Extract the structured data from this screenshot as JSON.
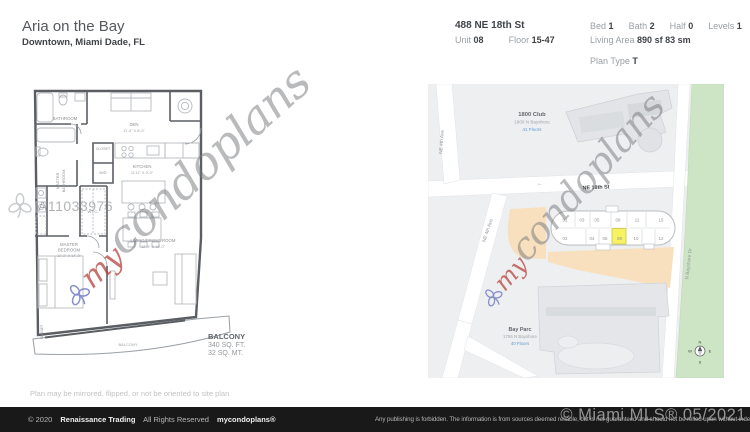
{
  "header": {
    "title": "Aria on the Bay",
    "subtitle": "Downtown, Miami Dade, FL",
    "address": "488 NE 18th St",
    "unit_label": "Unit",
    "unit_value": "08",
    "floor_label": "Floor",
    "floor_value": "15-47",
    "bed_label": "Bed",
    "bed_value": "1",
    "bath_label": "Bath",
    "bath_value": "2",
    "half_label": "Half",
    "half_value": "0",
    "levels_label": "Levels",
    "levels_value": "1",
    "living_label": "Living Area",
    "living_value": "890 sf 83 sm",
    "plan_type_label": "Plan Type",
    "plan_type_value": "T"
  },
  "plan": {
    "id_watermark": "A11033976",
    "bathroom": "BATHROOM",
    "master_bathroom_1": "MASTER",
    "master_bathroom_2": "BATHROOM",
    "den": "DEN",
    "den_dims": "11'-5\" X 8'-0\"",
    "closet_center": "CLOSET",
    "wd": "W/D",
    "kitchen": "KITCHEN",
    "kitchen_dims": "11'11\" X 9'-0\"",
    "wic": "W.I.C.",
    "closet_left": "CLOSET",
    "master_bedroom_1": "MASTER",
    "master_bedroom_2": "BEDROOM",
    "master_bedroom_dims": "11'-2\" X 14'-3\"",
    "living": "LIVING/DINING ROOM",
    "living_dims": "12'-9\" X 15'-0\"",
    "balcony": "BALCONY",
    "balcony_note1": "BALCONY",
    "balcony_note2": "340 SQ. FT.",
    "balcony_note3": "32 SQ. MT.",
    "disclaimer": "Plan may be mirrored, flipped, or not be oriented to site plan"
  },
  "map": {
    "street_ne4_top": "NE 4th Ave",
    "street_ne4_mid": "NE 4th Ave",
    "street_ne18": "NE 18th St",
    "street_bayshore": "N Bayshore Dr",
    "road_arrow": "←",
    "building_1800_name": "1800 Club",
    "building_1800_address": "1800 N Bayshore",
    "building_1800_floors": "41 Floors",
    "bayparc_name": "Bay Parc",
    "bayparc_address": "1756 N Bayshore",
    "bayparc_floors": "40 Floors",
    "units_top": [
      "01",
      "03",
      "05",
      "09",
      "11",
      "15"
    ],
    "units_bottom": [
      "02",
      "04",
      "06",
      "08",
      "10",
      "12"
    ],
    "highlighted_unit": "08",
    "compass_n": "N",
    "compass_e": "E",
    "compass_s": "S",
    "compass_w": "W",
    "colors": {
      "highlight": "#f6f263",
      "park": "#cde5c4",
      "parcel": "#f8dfbd",
      "floors_blue": "#5b9bd5"
    }
  },
  "brand": {
    "prefix": "my",
    "suffix": "condoplans"
  },
  "footer": {
    "copyright": "© 2020",
    "company": "Renaissance Trading",
    "rights": "All Rights Reserved",
    "brand": "mycondoplans®",
    "disclaimer": "Any publishing is forbidden.  The information is from sources deemed reliable, but is not guaranteed and should not be relied upon without independent verification.",
    "mls": "© Miami MLS® 05/2021"
  }
}
